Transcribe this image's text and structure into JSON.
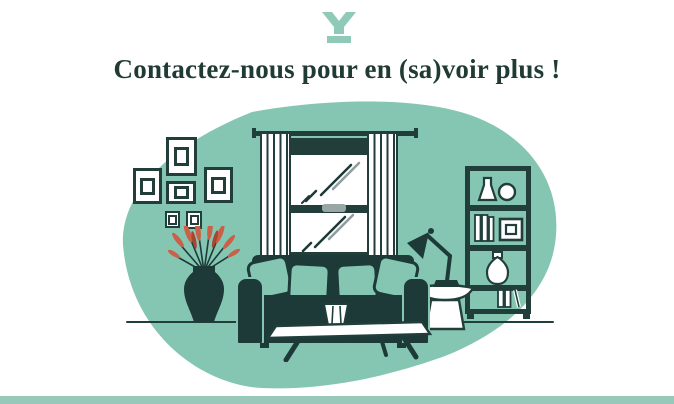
{
  "page": {
    "background": "#ffffff"
  },
  "logo": {
    "icon": "brand-y-icon",
    "color": "#8fc9b8"
  },
  "heading": {
    "text": "Contactez-nous pour en (sa)voir plus !",
    "color": "#1f3b33"
  },
  "illustration": {
    "name": "living-room-illustration",
    "blob_color": "#85c6b3",
    "ink_color": "#213e3b",
    "accent_color": "#cc5f47",
    "latch_color": "#9aa6a4",
    "items": [
      "gallery-picture-frames",
      "window-with-white-curtains",
      "vase-with-red-plant",
      "dark-green-sofa-with-teal-pillows",
      "white-coffee-table-with-small-vase",
      "desk-lamp",
      "white-pedestal-side-table",
      "dark-bookshelf-with-books-and-vases"
    ]
  },
  "footer": {
    "bar_color": "#97c8b9"
  }
}
